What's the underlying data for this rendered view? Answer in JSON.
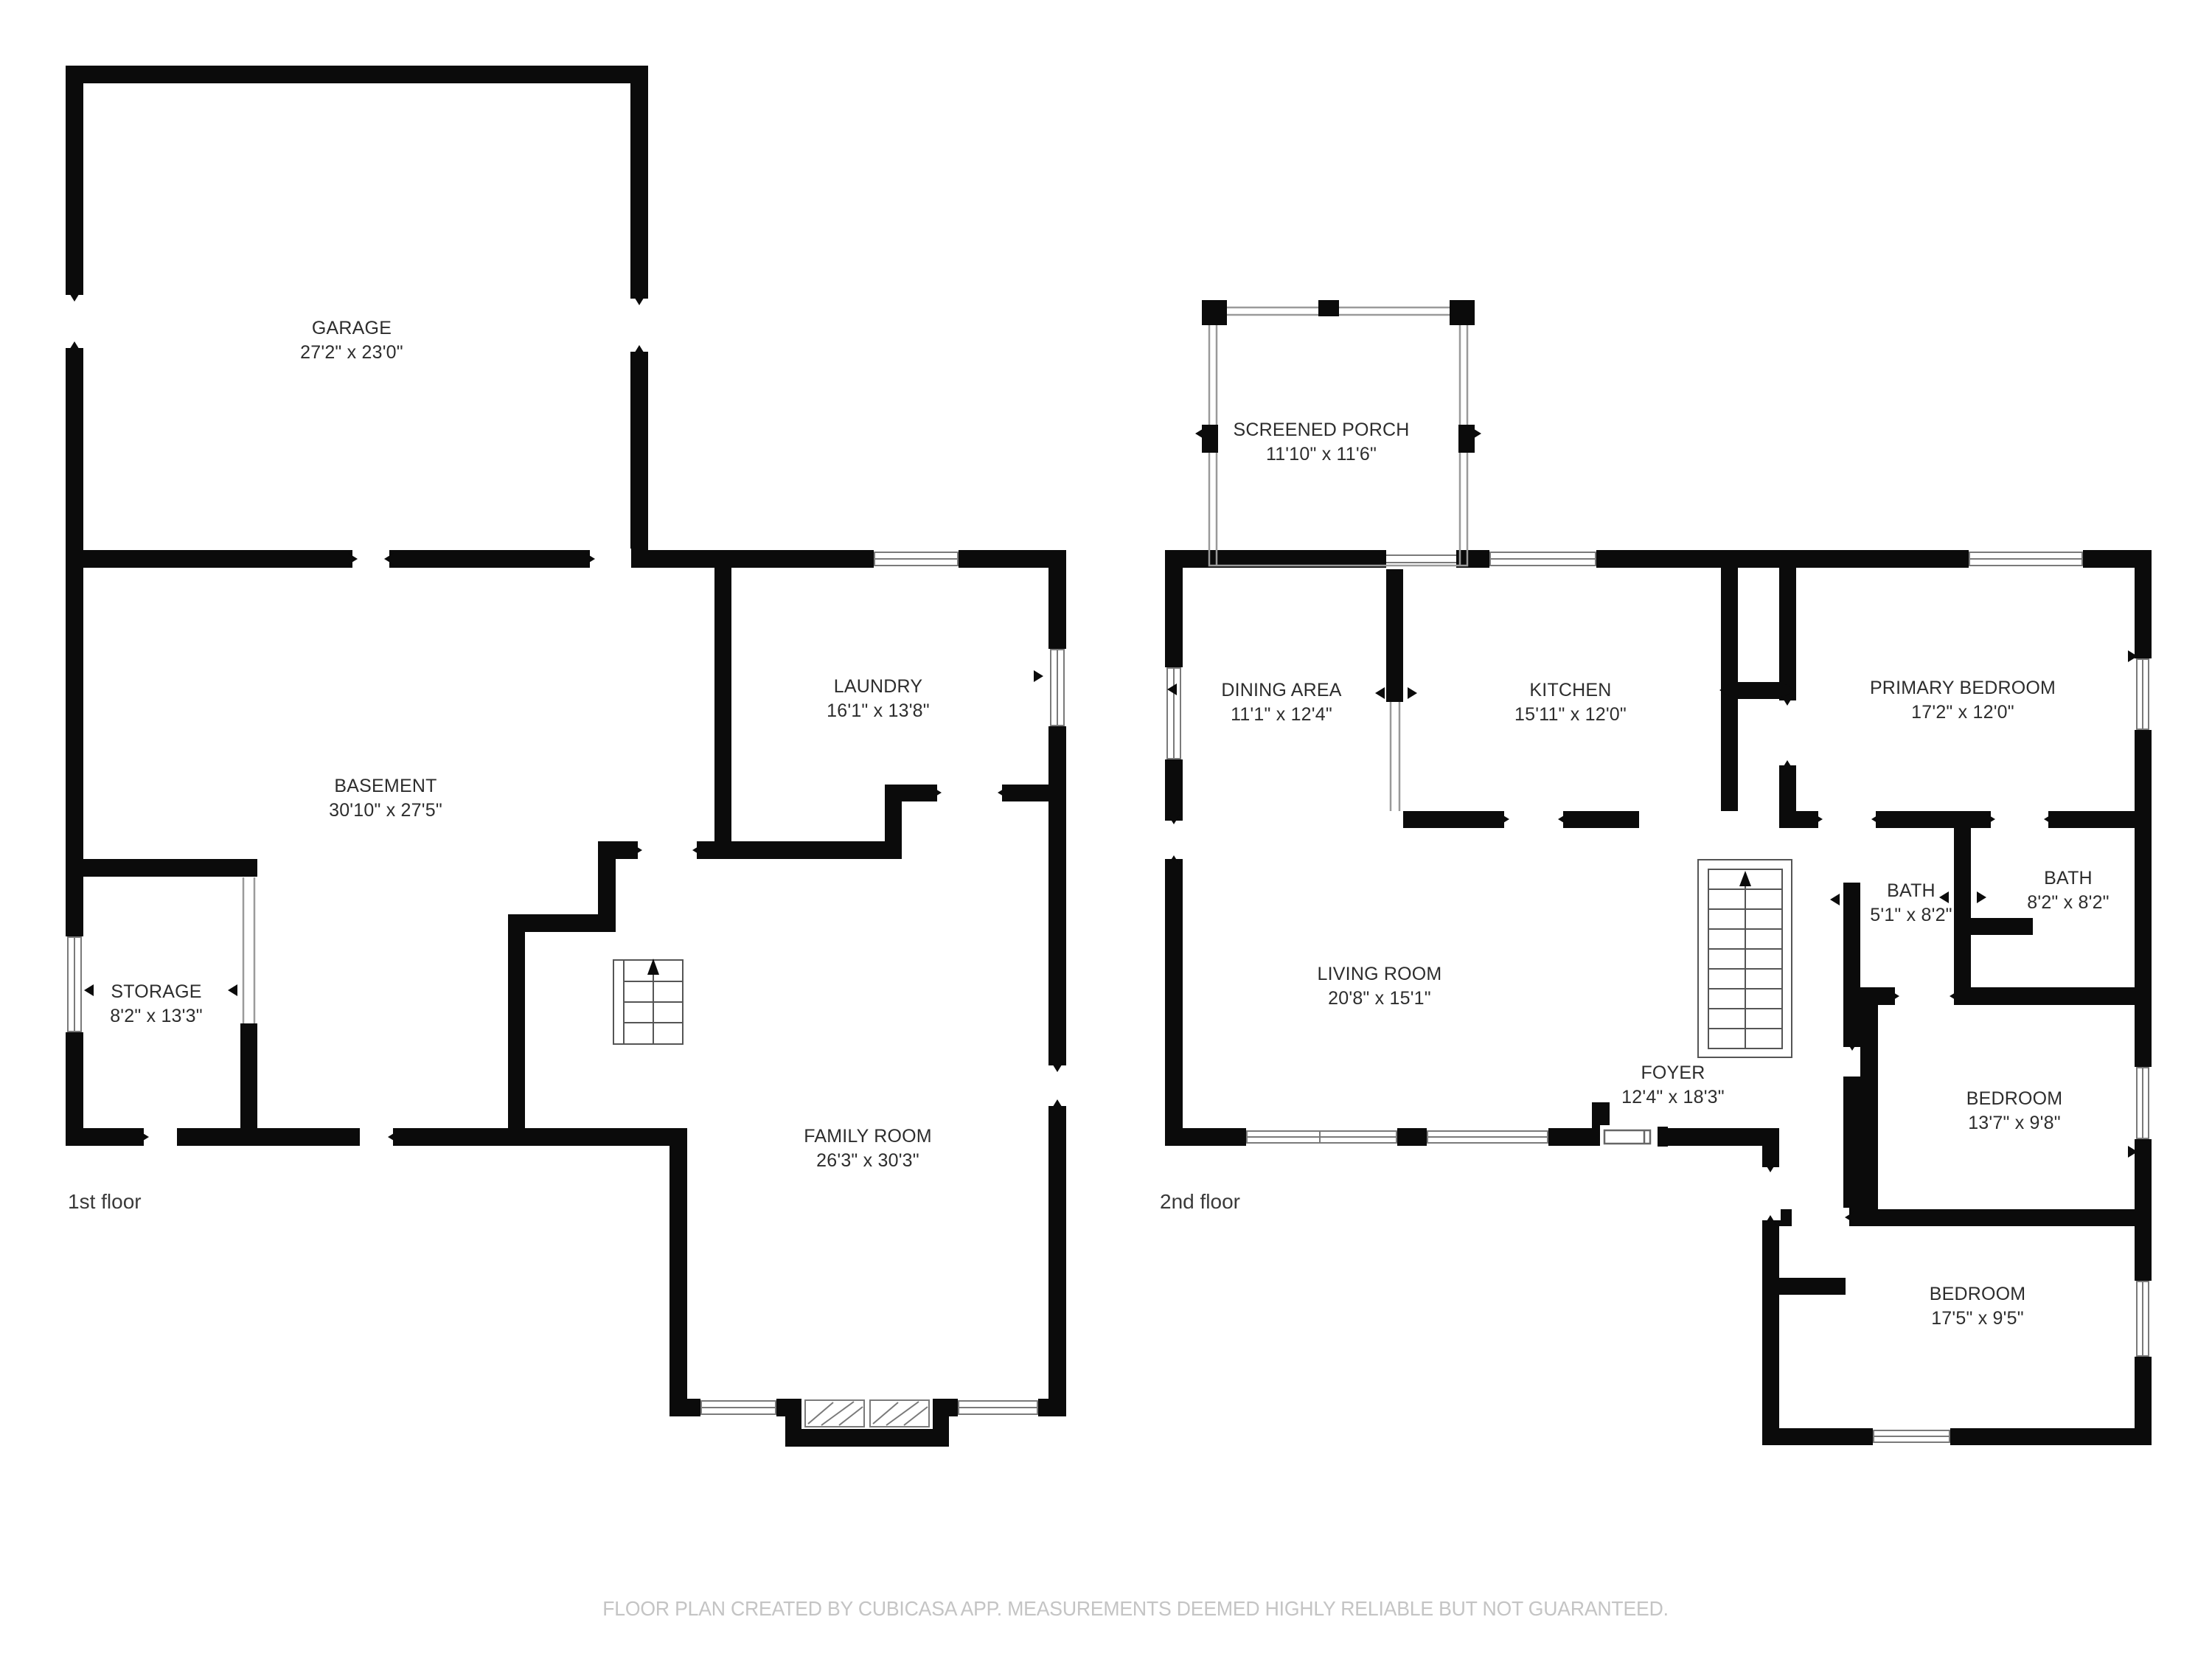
{
  "footer_note": "FLOOR PLAN CREATED BY CUBICASA APP. MEASUREMENTS DEEMED HIGHLY RELIABLE BUT NOT GUARANTEED.",
  "colors": {
    "wall": "#0b0b0b",
    "thin_line": "#9a9a9a",
    "label_text": "#2d2d2d",
    "footer_text": "#c4c4c4"
  },
  "floor1": {
    "label": "1st floor",
    "rooms": {
      "garage": {
        "name": "GARAGE",
        "dims": "27'2\" x 23'0\""
      },
      "laundry": {
        "name": "LAUNDRY",
        "dims": "16'1\" x 13'8\""
      },
      "basement": {
        "name": "BASEMENT",
        "dims": "30'10\" x 27'5\""
      },
      "storage": {
        "name": "STORAGE",
        "dims": "8'2\" x 13'3\""
      },
      "family": {
        "name": "FAMILY ROOM",
        "dims": "26'3\" x 30'3\""
      }
    }
  },
  "floor2": {
    "label": "2nd floor",
    "rooms": {
      "porch": {
        "name": "SCREENED PORCH",
        "dims": "11'10\" x 11'6\""
      },
      "dining": {
        "name": "DINING AREA",
        "dims": "11'1\" x 12'4\""
      },
      "kitchen": {
        "name": "KITCHEN",
        "dims": "15'11\" x 12'0\""
      },
      "primary": {
        "name": "PRIMARY BEDROOM",
        "dims": "17'2\" x 12'0\""
      },
      "bath1": {
        "name": "BATH",
        "dims": "5'1\" x 8'2\""
      },
      "bath2": {
        "name": "BATH",
        "dims": "8'2\" x 8'2\""
      },
      "living": {
        "name": "LIVING ROOM",
        "dims": "20'8\" x 15'1\""
      },
      "foyer": {
        "name": "FOYER",
        "dims": "12'4\" x 18'3\""
      },
      "bedroom_mid": {
        "name": "BEDROOM",
        "dims": "13'7\" x 9'8\""
      },
      "bedroom_bottom": {
        "name": "BEDROOM",
        "dims": "17'5\" x 9'5\""
      }
    }
  }
}
